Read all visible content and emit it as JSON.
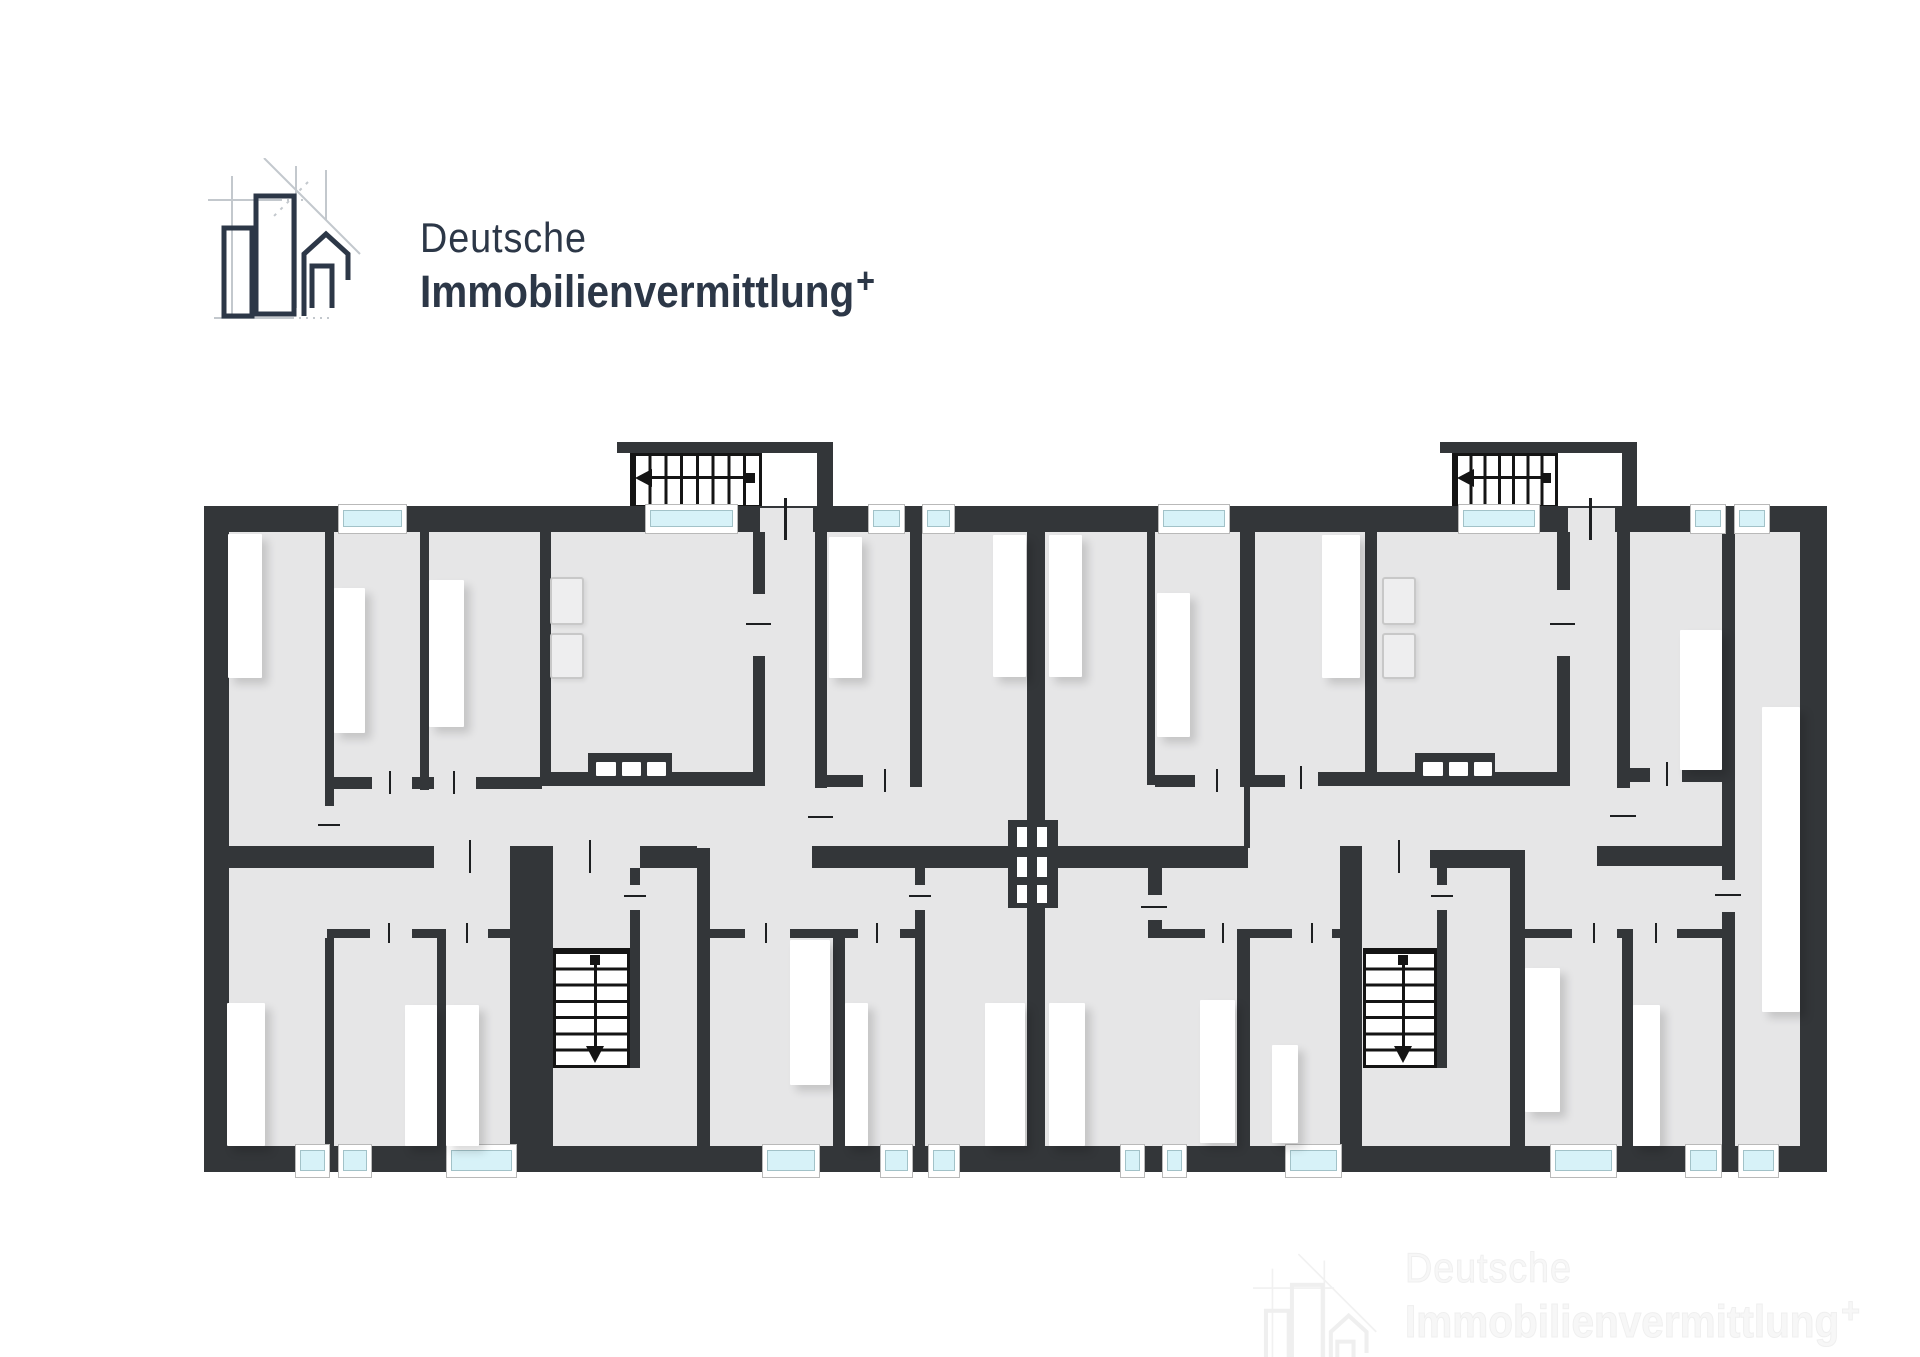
{
  "logo": {
    "line1": "Deutsche",
    "line2": "Immobilienvermittlung",
    "plus": "+"
  },
  "watermark": {
    "line1": "Deutsche",
    "line2": "Immobilienvermittlung",
    "plus": "+"
  },
  "colors": {
    "wall": "#333639",
    "floor": "#e6e6e7",
    "window_glass": "#d7f2f8",
    "logo_navy": "#2c3747",
    "watermark": "#f3f3f3",
    "white": "#ffffff"
  },
  "plan": {
    "floor": [
      229,
      532,
      1571,
      614
    ],
    "walls": [
      [
        204,
        506,
        1623,
        26
      ],
      [
        204,
        1146,
        1623,
        26
      ],
      [
        204,
        506,
        25,
        666
      ],
      [
        1800,
        506,
        27,
        666
      ],
      [
        617,
        442,
        216,
        11
      ],
      [
        817,
        442,
        16,
        70
      ],
      [
        1440,
        442,
        197,
        11
      ],
      [
        1622,
        442,
        15,
        70
      ],
      [
        325,
        532,
        9,
        274
      ],
      [
        420,
        532,
        9,
        258
      ],
      [
        540,
        532,
        11,
        254
      ],
      [
        753,
        532,
        12,
        62
      ],
      [
        753,
        656,
        12,
        120
      ],
      [
        815,
        532,
        12,
        256
      ],
      [
        910,
        532,
        12,
        255
      ],
      [
        1027,
        532,
        18,
        290
      ],
      [
        1147,
        532,
        8,
        253
      ],
      [
        1240,
        532,
        15,
        253
      ],
      [
        1244,
        785,
        6,
        63
      ],
      [
        1365,
        532,
        12,
        244
      ],
      [
        1557,
        532,
        13,
        58
      ],
      [
        1557,
        656,
        13,
        120
      ],
      [
        1617,
        532,
        13,
        256
      ],
      [
        1722,
        532,
        13,
        240
      ],
      [
        325,
        777,
        47,
        12
      ],
      [
        412,
        777,
        22,
        12
      ],
      [
        476,
        777,
        66,
        12
      ],
      [
        540,
        772,
        225,
        14
      ],
      [
        815,
        775,
        48,
        12
      ],
      [
        1155,
        775,
        40,
        12
      ],
      [
        1240,
        775,
        45,
        12
      ],
      [
        1318,
        772,
        252,
        14
      ],
      [
        1630,
        768,
        20,
        14
      ],
      [
        1682,
        768,
        53,
        14
      ],
      [
        204,
        846,
        230,
        22
      ],
      [
        510,
        846,
        43,
        300
      ],
      [
        640,
        846,
        57,
        22
      ],
      [
        697,
        848,
        13,
        298
      ],
      [
        812,
        846,
        196,
        22
      ],
      [
        1058,
        846,
        190,
        22
      ],
      [
        1340,
        846,
        22,
        300
      ],
      [
        1430,
        850,
        95,
        18
      ],
      [
        1510,
        852,
        15,
        294
      ],
      [
        1597,
        846,
        125,
        20
      ],
      [
        1722,
        782,
        13,
        98
      ],
      [
        1722,
        912,
        13,
        234
      ],
      [
        630,
        868,
        10,
        17
      ],
      [
        630,
        910,
        10,
        158
      ],
      [
        1437,
        868,
        10,
        17
      ],
      [
        1437,
        910,
        10,
        158
      ],
      [
        915,
        868,
        10,
        17
      ],
      [
        915,
        910,
        10,
        236
      ],
      [
        1148,
        868,
        14,
        27
      ],
      [
        1148,
        920,
        14,
        18
      ],
      [
        1027,
        908,
        18,
        238
      ],
      [
        327,
        929,
        43,
        9
      ],
      [
        412,
        929,
        34,
        9
      ],
      [
        488,
        929,
        29,
        9
      ],
      [
        325,
        938,
        9,
        208
      ],
      [
        437,
        938,
        9,
        208
      ],
      [
        709,
        929,
        36,
        9
      ],
      [
        790,
        929,
        68,
        9
      ],
      [
        900,
        929,
        15,
        9
      ],
      [
        833,
        938,
        12,
        208
      ],
      [
        1162,
        929,
        43,
        9
      ],
      [
        1250,
        929,
        42,
        9
      ],
      [
        1332,
        929,
        30,
        9
      ],
      [
        1237,
        929,
        13,
        217
      ],
      [
        1525,
        929,
        47,
        9
      ],
      [
        1617,
        929,
        16,
        9
      ],
      [
        1677,
        929,
        53,
        9
      ],
      [
        1622,
        938,
        11,
        208
      ]
    ],
    "door_gaps": [
      [
        760,
        508,
        53,
        24
      ],
      [
        1568,
        508,
        47,
        24
      ]
    ],
    "windows": [
      [
        338,
        504,
        69,
        30
      ],
      [
        645,
        504,
        93,
        30
      ],
      [
        868,
        504,
        37,
        30
      ],
      [
        922,
        504,
        33,
        30
      ],
      [
        1158,
        504,
        72,
        30
      ],
      [
        1458,
        504,
        82,
        30
      ],
      [
        1690,
        504,
        36,
        30
      ],
      [
        1734,
        504,
        36,
        30
      ],
      [
        295,
        1144,
        35,
        34
      ],
      [
        338,
        1144,
        34,
        34
      ],
      [
        446,
        1144,
        71,
        34
      ],
      [
        762,
        1144,
        58,
        34
      ],
      [
        880,
        1144,
        33,
        34
      ],
      [
        928,
        1144,
        32,
        34
      ],
      [
        1120,
        1144,
        25,
        34
      ],
      [
        1162,
        1144,
        25,
        34
      ],
      [
        1285,
        1144,
        57,
        34
      ],
      [
        1550,
        1144,
        67,
        34
      ],
      [
        1685,
        1144,
        37,
        34
      ],
      [
        1738,
        1144,
        41,
        34
      ]
    ],
    "furniture": [
      [
        228,
        534,
        34,
        144
      ],
      [
        334,
        588,
        31,
        145
      ],
      [
        429,
        580,
        35,
        147
      ],
      [
        829,
        537,
        33,
        141
      ],
      [
        993,
        535,
        33,
        142
      ],
      [
        1049,
        535,
        33,
        142
      ],
      [
        1157,
        593,
        33,
        144
      ],
      [
        1322,
        535,
        38,
        143
      ],
      [
        1680,
        630,
        42,
        140
      ],
      [
        1762,
        707,
        38,
        305
      ],
      [
        227,
        1003,
        38,
        143
      ],
      [
        405,
        1005,
        32,
        141
      ],
      [
        446,
        1005,
        33,
        141
      ],
      [
        790,
        940,
        40,
        145
      ],
      [
        845,
        1003,
        23,
        143
      ],
      [
        985,
        1003,
        40,
        143
      ],
      [
        1049,
        1003,
        36,
        143
      ],
      [
        1200,
        1000,
        35,
        143
      ],
      [
        1272,
        1045,
        26,
        98
      ],
      [
        1525,
        968,
        35,
        144
      ],
      [
        1633,
        1005,
        27,
        141
      ]
    ],
    "appliances": [
      [
        550,
        577,
        34,
        48
      ],
      [
        550,
        633,
        34,
        46
      ],
      [
        1382,
        577,
        34,
        48
      ],
      [
        1382,
        633,
        34,
        46
      ]
    ],
    "counters": [
      [
        588,
        753,
        84,
        33
      ],
      [
        1415,
        753,
        80,
        33
      ]
    ],
    "burners": [
      [
        596,
        762,
        20,
        14
      ],
      [
        622,
        762,
        19,
        14
      ],
      [
        647,
        762,
        19,
        14
      ],
      [
        1423,
        762,
        20,
        14
      ],
      [
        1449,
        762,
        19,
        14
      ],
      [
        1474,
        762,
        18,
        14
      ]
    ],
    "chimney": [
      1008,
      820,
      50,
      88
    ],
    "flues": [
      [
        1017,
        827,
        10,
        20
      ],
      [
        1037,
        827,
        10,
        20
      ],
      [
        1017,
        857,
        10,
        20
      ],
      [
        1037,
        857,
        10,
        20
      ],
      [
        1017,
        885,
        10,
        18
      ],
      [
        1037,
        885,
        10,
        18
      ]
    ],
    "stairs": [
      {
        "box": [
          630,
          453,
          132,
          55
        ],
        "dir": "left",
        "treads": 8
      },
      {
        "box": [
          1452,
          453,
          106,
          55
        ],
        "dir": "left",
        "treads": 7
      },
      {
        "box": [
          553,
          948,
          77,
          120
        ],
        "dir": "down",
        "treads": 7
      },
      {
        "box": [
          1363,
          948,
          74,
          120
        ],
        "dir": "down",
        "treads": 7
      }
    ],
    "ticks": [
      [
        784,
        498,
        3,
        42
      ],
      [
        1589,
        498,
        3,
        42
      ],
      [
        389,
        771,
        2,
        23
      ],
      [
        453,
        771,
        2,
        23
      ],
      [
        746,
        623,
        25,
        2
      ],
      [
        1550,
        623,
        25,
        2
      ],
      [
        318,
        824,
        22,
        2
      ],
      [
        808,
        816,
        25,
        2
      ],
      [
        1610,
        815,
        26,
        2
      ],
      [
        884,
        769,
        2,
        23
      ],
      [
        1216,
        769,
        2,
        23
      ],
      [
        1300,
        766,
        2,
        23
      ],
      [
        1666,
        762,
        2,
        24
      ],
      [
        469,
        840,
        2,
        33
      ],
      [
        589,
        840,
        2,
        33
      ],
      [
        1398,
        840,
        2,
        33
      ],
      [
        624,
        895,
        22,
        2
      ],
      [
        1431,
        895,
        22,
        2
      ],
      [
        909,
        895,
        22,
        2
      ],
      [
        1141,
        906,
        26,
        2
      ],
      [
        1715,
        894,
        26,
        2
      ],
      [
        388,
        923,
        2,
        20
      ],
      [
        466,
        923,
        2,
        20
      ],
      [
        765,
        923,
        2,
        20
      ],
      [
        876,
        923,
        2,
        20
      ],
      [
        1222,
        923,
        2,
        20
      ],
      [
        1311,
        923,
        2,
        20
      ],
      [
        1593,
        923,
        2,
        20
      ],
      [
        1655,
        923,
        2,
        20
      ]
    ]
  }
}
